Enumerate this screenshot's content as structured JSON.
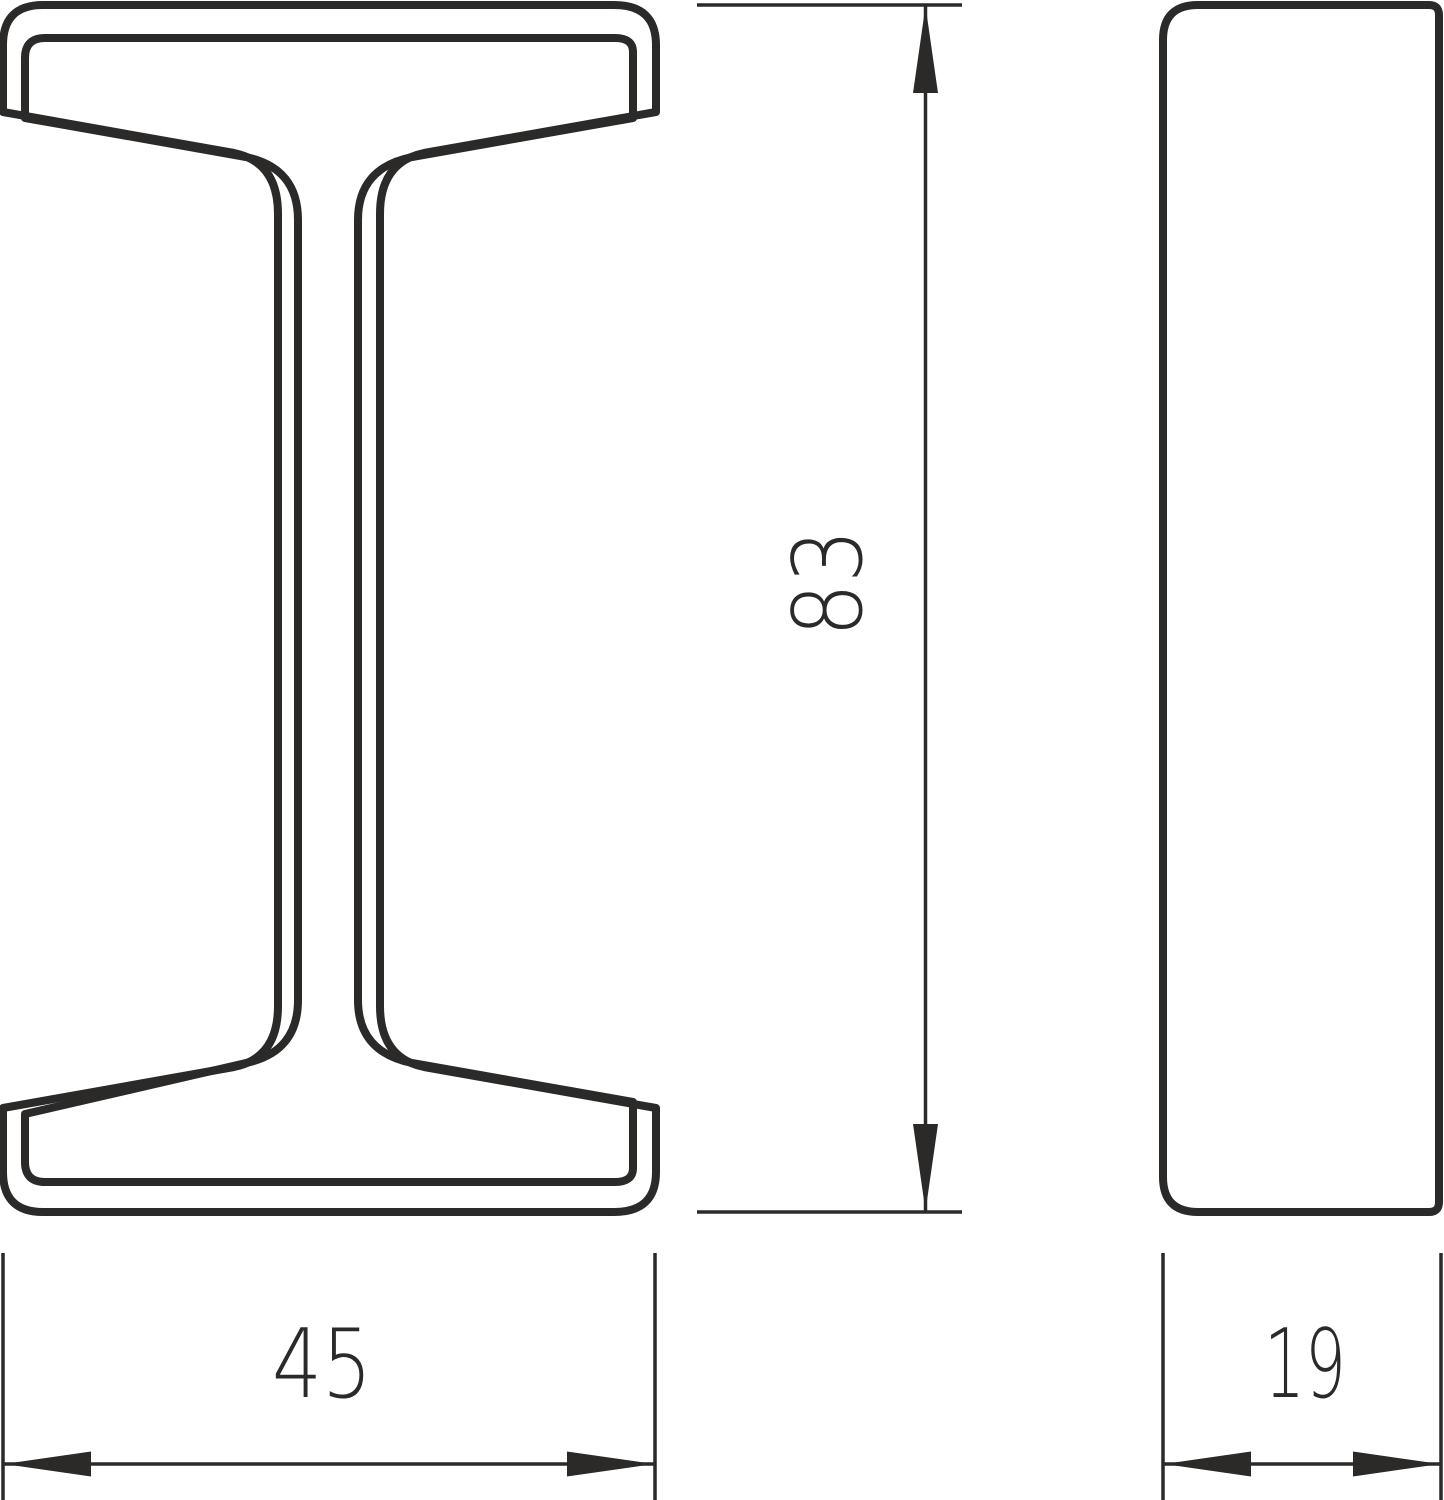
{
  "drawing": {
    "type": "technical-profile-drawing",
    "subject": "i-beam-extrusion-profile",
    "colors": {
      "line": "#2b2a29",
      "background": "#ffffff"
    },
    "views": {
      "front": {
        "name": "I-beam cross-section front view"
      },
      "side": {
        "name": "profile side view"
      }
    },
    "dimensions": {
      "height": {
        "value": "83"
      },
      "width": {
        "value": "45"
      },
      "depth": {
        "value": "19"
      }
    }
  }
}
